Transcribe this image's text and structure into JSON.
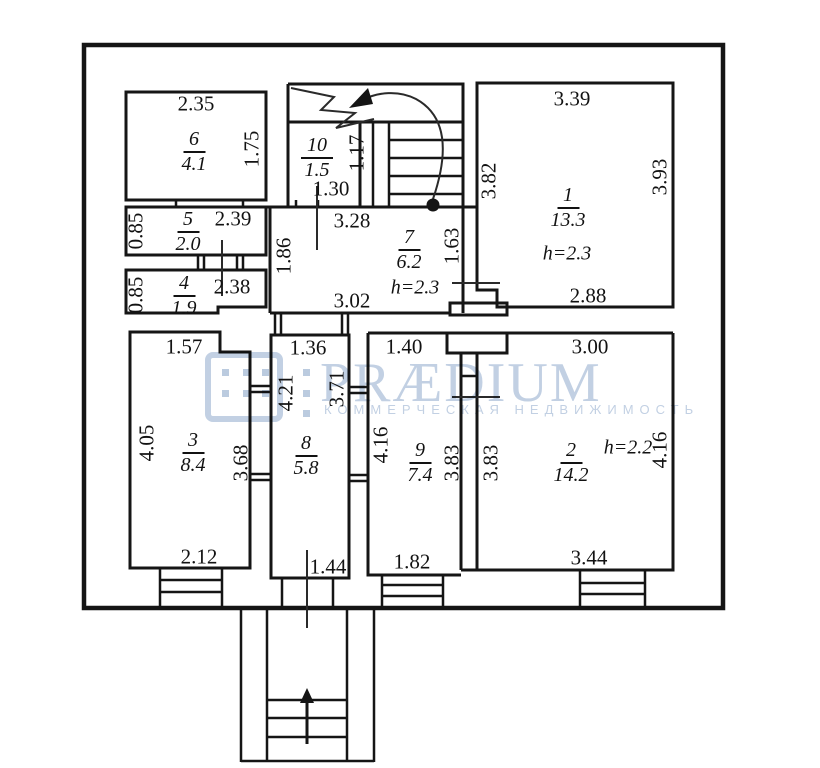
{
  "plan": {
    "wall_color": "#151515",
    "rooms": {
      "r1": {
        "number": "1",
        "area": "13.3",
        "height": "h=2.3",
        "dim_top": "3.39",
        "dim_left": "3.82",
        "dim_right": "3.93",
        "dim_bottom": "2.88"
      },
      "r2": {
        "number": "2",
        "area": "14.2",
        "height": "h=2.2",
        "dim_top": "3.00",
        "dim_left": "3.83",
        "dim_right": "4.16",
        "dim_bottom": "3.44"
      },
      "r3": {
        "number": "3",
        "area": "8.4",
        "dim_top": "1.57",
        "dim_left": "4.05",
        "dim_right": "3.68",
        "dim_bottom": "2.12"
      },
      "r4": {
        "number": "4",
        "area": "1.9",
        "dim_left": "0.85",
        "dim_right": "2.38"
      },
      "r5": {
        "number": "5",
        "area": "2.0",
        "dim_left": "0.85",
        "dim_right": "2.39"
      },
      "r6": {
        "number": "6",
        "area": "4.1",
        "dim_top": "2.35",
        "dim_right": "1.75"
      },
      "r7": {
        "number": "7",
        "area": "6.2",
        "height": "h=2.3",
        "dim_top": "3.28",
        "dim_left": "1.86",
        "dim_right": "1.63",
        "dim_bottom": "3.02"
      },
      "r8": {
        "number": "8",
        "area": "5.8",
        "dim_top": "1.36",
        "dim_left": "4.21",
        "dim_right": "3.71",
        "dim_bottom": "1.44"
      },
      "r9": {
        "number": "9",
        "area": "7.4",
        "dim_top": "1.40",
        "dim_left": "4.16",
        "dim_right": "3.83",
        "dim_bottom": "1.82"
      },
      "r10": {
        "number": "10",
        "area": "1.5",
        "dim_right": "1.17",
        "dim_bottom": "1.30"
      }
    }
  },
  "watermark": {
    "brand": "PRÆDIUM",
    "tagline": "КОММЕРЧЕСКАЯ НЕДВИЖИМОСТЬ",
    "color": "#b7c8de"
  }
}
